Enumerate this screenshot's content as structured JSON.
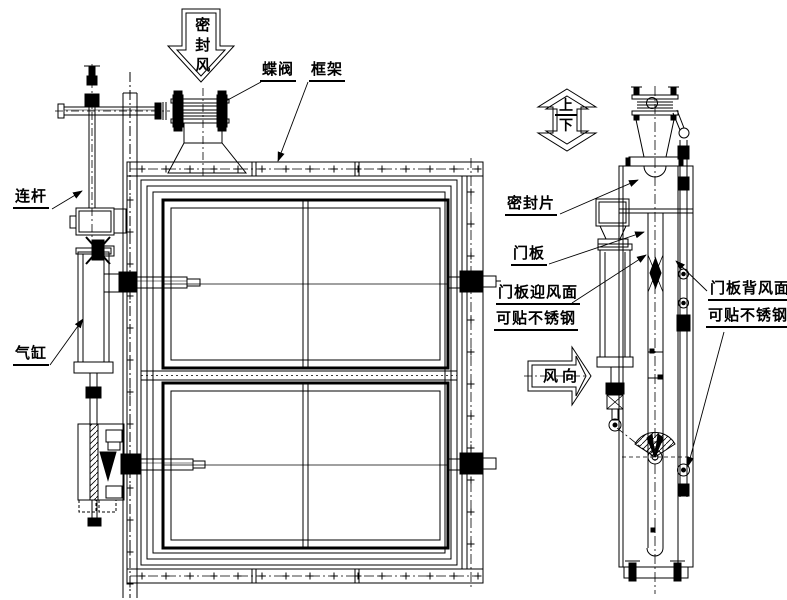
{
  "labels": {
    "seal_air": "密封风",
    "butterfly_valve": "蝶阀",
    "frame": "框架",
    "link_rod": "连杆",
    "cylinder": "气缸",
    "seal_strip": "密封片",
    "door_panel": "门板",
    "windward_line1": "门板迎风面",
    "windward_line2": "可贴不锈钢",
    "leeward_line1": "门板背风面",
    "leeward_line2": "可贴不锈钢",
    "up": "上",
    "down": "下",
    "wind_direction": "风向"
  },
  "colors": {
    "line": "#000000",
    "background": "#ffffff"
  }
}
